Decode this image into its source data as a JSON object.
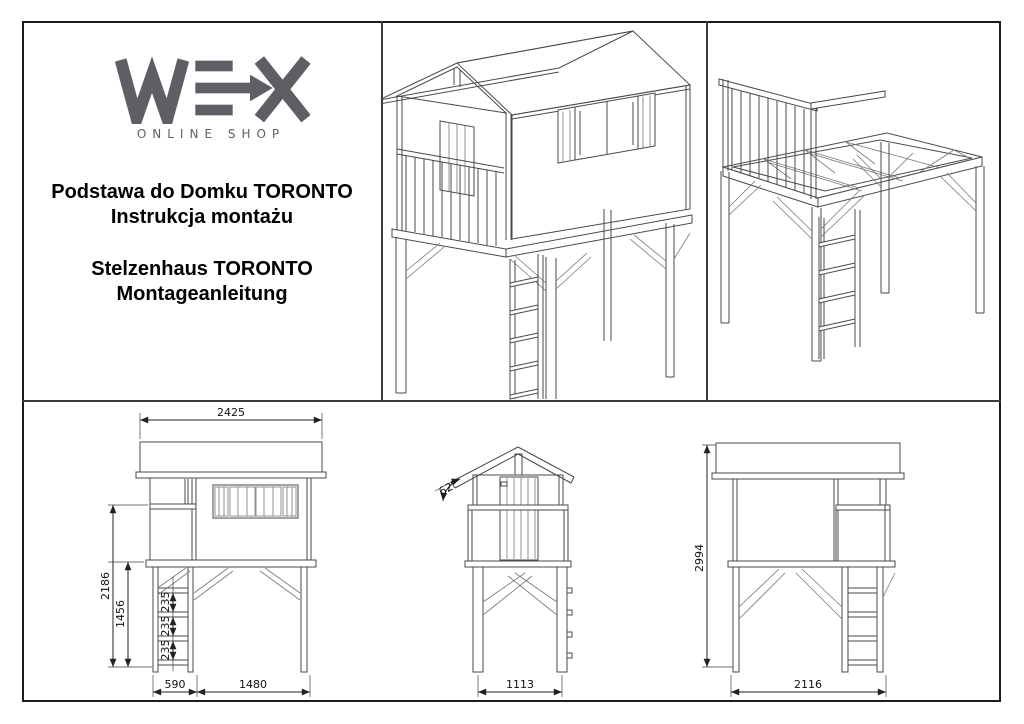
{
  "logo": {
    "brand": "WEX",
    "subtitle": "ONLINE SHOP"
  },
  "titles": {
    "pl_line1": "Podstawa do Domku TORONTO",
    "pl_line2": "Instrukcja montażu",
    "de_line1": "Stelzenhaus TORONTO",
    "de_line2": "Montageanleitung"
  },
  "dimensions": {
    "side_view": {
      "roof_width": "2425",
      "total_height": "2186",
      "platform_height": "1456",
      "rung_gaps": [
        "235",
        "235",
        "235"
      ],
      "ladder_width": "590",
      "frame_width": "1480"
    },
    "front_view": {
      "roof_angle": "62°",
      "frame_width": "1113"
    },
    "rear_view": {
      "total_height": "2994",
      "frame_width": "2116"
    }
  }
}
